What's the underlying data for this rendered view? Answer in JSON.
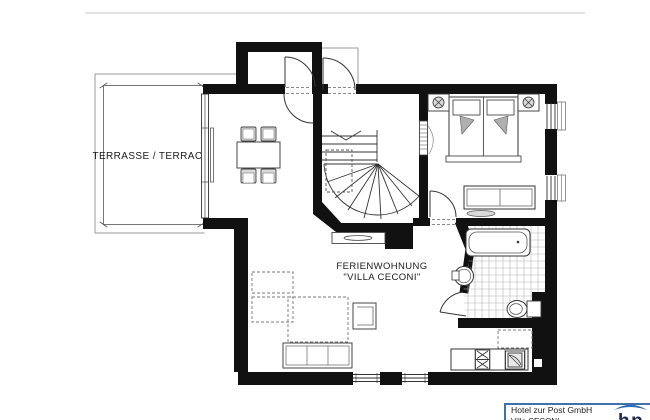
{
  "plan": {
    "terrace_label": "TERRASSE / TERRACE",
    "apartment_label_line1": "FERIENWOHNUNG",
    "apartment_label_line2": "\"VILLA CECONI\""
  },
  "title_block": {
    "company": "Hotel zur Post GmbH",
    "address_line_partial": "Villa CECONI",
    "logo_text": "hp"
  },
  "colors": {
    "ink": "#111111",
    "thin_line": "#999999",
    "accent_blue": "#3f72ad",
    "logo_roof_blue": "#2e6cb5",
    "logo_navy": "#1c2a52"
  },
  "icons": {
    "dining-table-icon": "rect",
    "chair-icon": "nested-rect",
    "double-bed-icon": "rect-pillows",
    "nightstand-lamp-icon": "circle-cross",
    "bench-icon": "nested-rect",
    "rug-icon": "ellipse",
    "bathtub-icon": "rounded-rect",
    "washbasin-icon": "circle-tap",
    "toilet-icon": "oval-tank",
    "kitchen-sink-icon": "double-x",
    "stove-icon": "square-door",
    "sofa-icon": "sectioned-rect",
    "armchair-icon": "open-rect",
    "stairs-icon": "winder-fan",
    "sliding-door-icon": "double-line",
    "door-swing-icon": "quarter-arc",
    "radiator-icon": "hatched-strip",
    "sideboard-icon": "rect-oval"
  }
}
